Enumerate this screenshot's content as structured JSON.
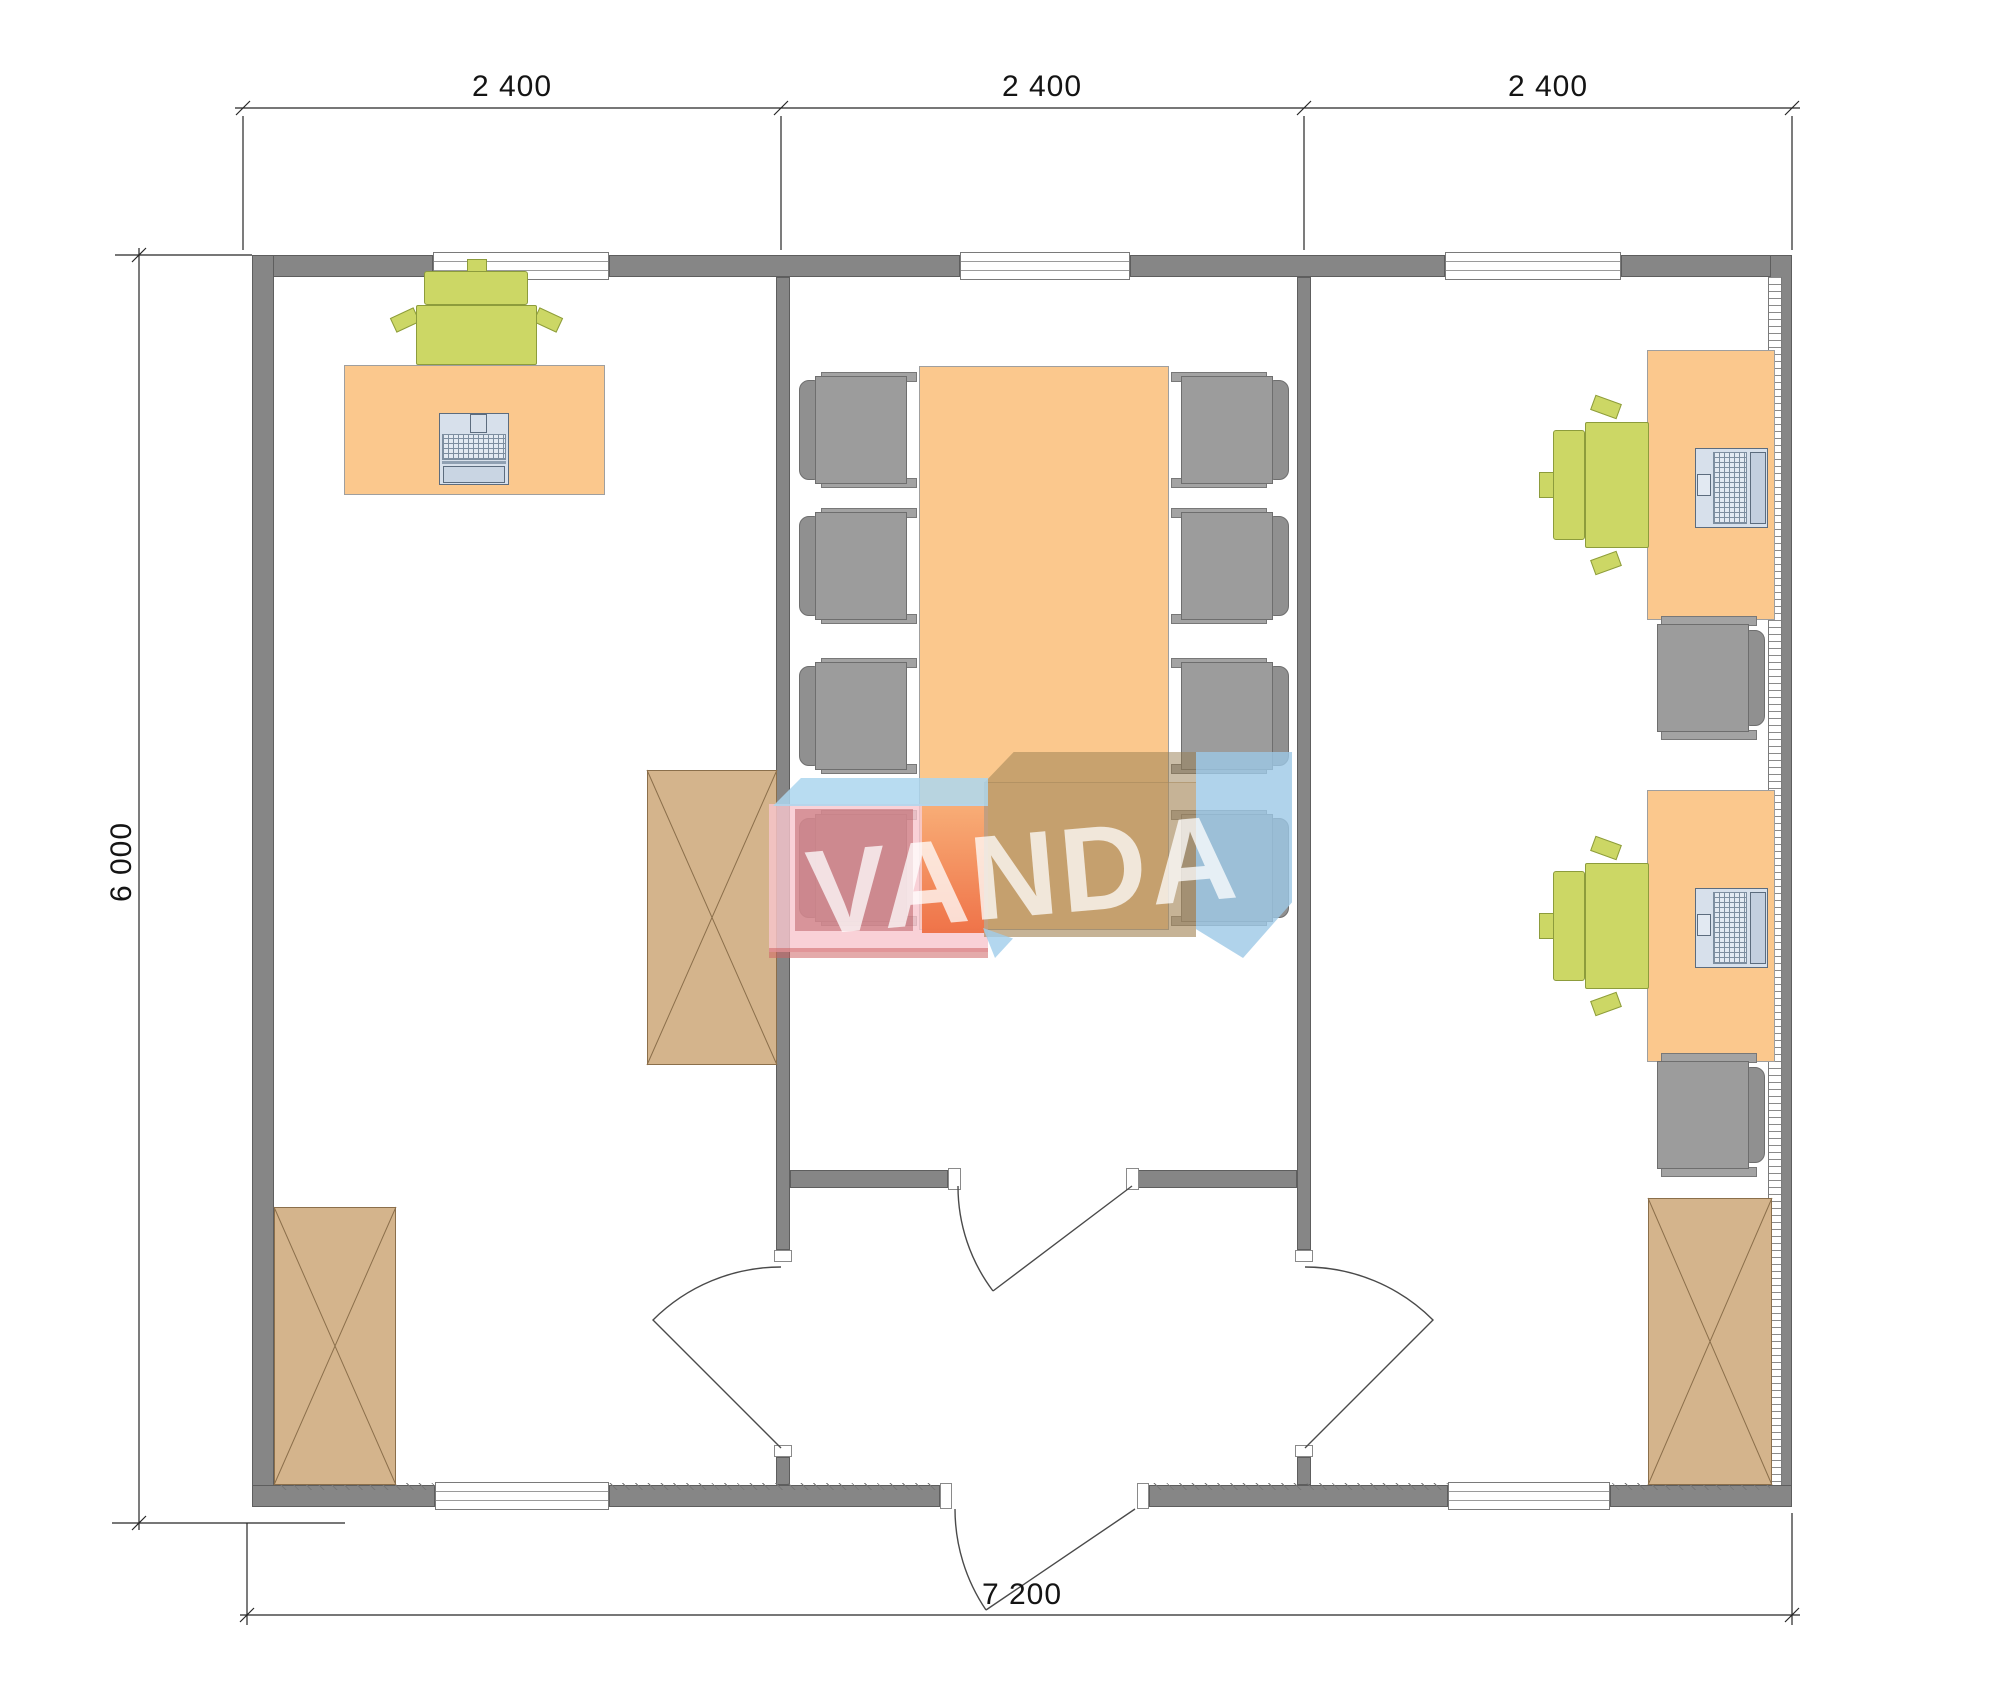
{
  "drawing": {
    "type": "floor-plan",
    "background": "#ffffff"
  },
  "dimensions": {
    "top": [
      "2 400",
      "2 400",
      "2 400"
    ],
    "left": "6 000",
    "bottom": "7 200"
  },
  "logo": {
    "text": "VANDA",
    "colors": {
      "blue": "#abd6ee",
      "pink": "#f7c6cd",
      "red": "#b04a50",
      "orange": "#ee6a3c",
      "tan": "#a88a5e",
      "letters": "rgba(255,255,255,0.75)"
    }
  },
  "colors": {
    "wall": "#868686",
    "desk": "#fbc88d",
    "cabinet": "#d4b48c",
    "chair_green": "#ccd765",
    "chair_gray": "#9c9c9c",
    "laptop": "#d7e0eb",
    "dimension_text": "#141414"
  }
}
